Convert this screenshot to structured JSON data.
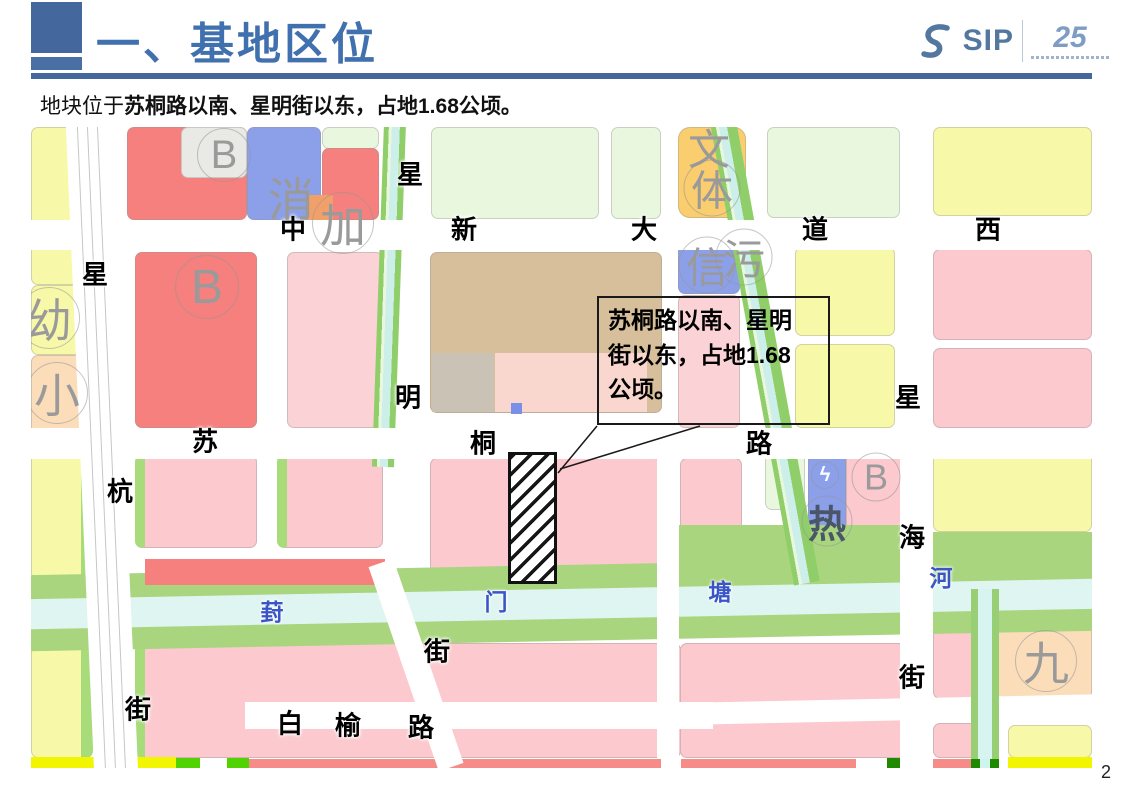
{
  "slide": {
    "title": "一、基地区位",
    "subtitle_prefix": "地块位于",
    "subtitle_emphasis": "苏桐路以南、星明街以东，占地1.68公顷。",
    "page_number": "2",
    "accent_color": "#44679E"
  },
  "logo": {
    "text": "SIP",
    "anniversary": "25"
  },
  "callout": {
    "text": "苏桐路以南、星明街以东，占地1.68公顷。"
  },
  "map": {
    "site": {
      "x": 477,
      "y": 325,
      "w": 49,
      "h": 132
    },
    "colors": {
      "residential_red": "#F5807E",
      "residential_pink": "#FBC9CE",
      "pale_pink": "#FBD3D6",
      "yellow": "#F8F9A8",
      "bright_yellow": "#F2F500",
      "pale_green": "#EAF7DF",
      "green_belt": "#A8D57E",
      "canal": "#DFF5F1",
      "utility_blue": "#8C9FE9",
      "construction_tan": "#D8BF9B",
      "peach": "#FBDDBA",
      "gray_parcel": "#E9E9E6",
      "gold": "#FACD6E"
    },
    "road_labels": [
      {
        "t": "星",
        "x": 64,
        "y": 146
      },
      {
        "t": "杭",
        "x": 89,
        "y": 363
      },
      {
        "t": "街",
        "x": 107,
        "y": 581
      },
      {
        "t": "星",
        "x": 379,
        "y": 46
      },
      {
        "t": "明",
        "x": 377,
        "y": 269
      },
      {
        "t": "街",
        "x": 406,
        "y": 523
      },
      {
        "t": "中",
        "x": 262,
        "y": 101
      },
      {
        "t": "新",
        "x": 433,
        "y": 101
      },
      {
        "t": "大",
        "x": 613,
        "y": 101
      },
      {
        "t": "道",
        "x": 784,
        "y": 101
      },
      {
        "t": "西",
        "x": 957,
        "y": 101
      },
      {
        "t": "苏",
        "x": 174,
        "y": 313
      },
      {
        "t": "桐",
        "x": 452,
        "y": 315
      },
      {
        "t": "路",
        "x": 728,
        "y": 315
      },
      {
        "t": "星",
        "x": 877,
        "y": 269
      },
      {
        "t": "海",
        "x": 881,
        "y": 409
      },
      {
        "t": "街",
        "x": 881,
        "y": 549
      },
      {
        "t": "白",
        "x": 259,
        "y": 595
      },
      {
        "t": "榆",
        "x": 317,
        "y": 597
      },
      {
        "t": "路",
        "x": 390,
        "y": 599
      }
    ],
    "water_labels": [
      {
        "t": "葑",
        "x": 241,
        "y": 483
      },
      {
        "t": "门",
        "x": 465,
        "y": 473
      },
      {
        "t": "塘",
        "x": 689,
        "y": 463
      },
      {
        "t": "河",
        "x": 910,
        "y": 449
      }
    ],
    "parcel_labels": [
      {
        "t": "B",
        "x": 193,
        "y": 28,
        "s": 40,
        "c": true
      },
      {
        "t": "消",
        "x": 260,
        "y": 70,
        "s": 46,
        "c": false
      },
      {
        "t": "加",
        "x": 312,
        "y": 96,
        "s": 46,
        "c": true
      },
      {
        "t": "B",
        "x": 176,
        "y": 160,
        "s": 48,
        "c": true
      },
      {
        "t": "幼",
        "x": 18,
        "y": 191,
        "s": 46,
        "c": true
      },
      {
        "t": "小",
        "x": 26,
        "y": 266,
        "s": 46,
        "c": true
      },
      {
        "t": "文",
        "x": 678,
        "y": 20,
        "s": 42,
        "c": false
      },
      {
        "t": "体",
        "x": 681,
        "y": 61,
        "s": 42,
        "c": true
      },
      {
        "t": "信",
        "x": 676,
        "y": 138,
        "s": 42,
        "c": true
      },
      {
        "t": "污",
        "x": 713,
        "y": 130,
        "s": 42,
        "c": true
      },
      {
        "t": "B",
        "x": 845,
        "y": 350,
        "s": 36,
        "c": true
      },
      {
        "t": "热",
        "x": 796,
        "y": 394,
        "s": 38,
        "c": true,
        "v": "dark"
      },
      {
        "t": "九",
        "x": 1015,
        "y": 534,
        "s": 46,
        "c": true
      },
      {
        "t": "ϟ",
        "x": 794,
        "y": 348,
        "s": 20,
        "c": true,
        "v": "white"
      }
    ]
  }
}
